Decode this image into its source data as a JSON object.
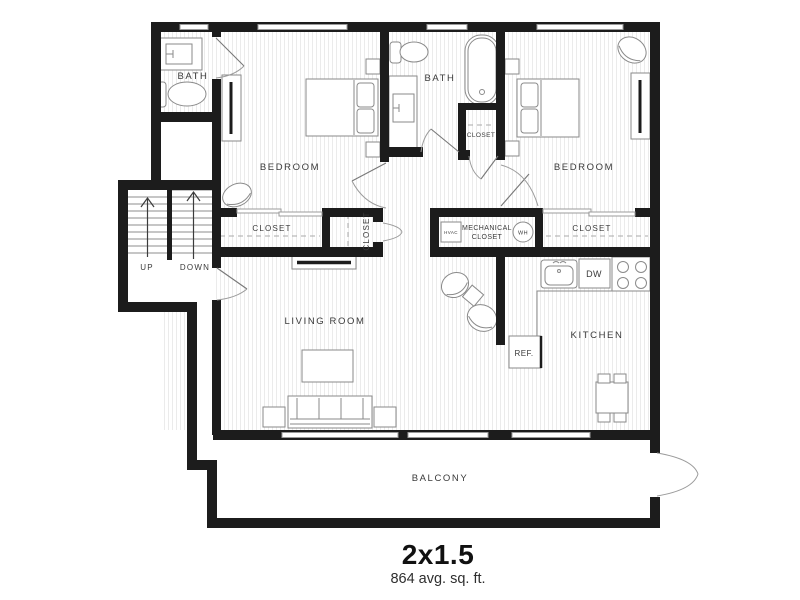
{
  "title": {
    "name": "2x1.5",
    "area": "864 avg. sq. ft."
  },
  "rooms": {
    "bath1": "BATH",
    "bath2": "BATH",
    "bedroom1": "BEDROOM",
    "bedroom2": "BEDROOM",
    "living": "LIVING ROOM",
    "kitchen": "KITCHEN",
    "balcony": "BALCONY"
  },
  "closets": {
    "closet1": "CLOSET",
    "closet2": "CLOSET",
    "closet3": "CLOSET",
    "closet4": "CLOSET",
    "mechanical_line1": "MECHANICAL",
    "mechanical_line2": "CLOSET"
  },
  "appliances": {
    "hvac": "HVAC",
    "water_heater": "WH",
    "dishwasher": "DW",
    "refrigerator": "REF."
  },
  "stairs": {
    "up": "UP",
    "down": "DOWN"
  },
  "colors": {
    "wall": "#1c1c1c",
    "fixture_line": "#8a8a8a",
    "hatch": "#ebebeb",
    "label": "#3a3a3a"
  }
}
